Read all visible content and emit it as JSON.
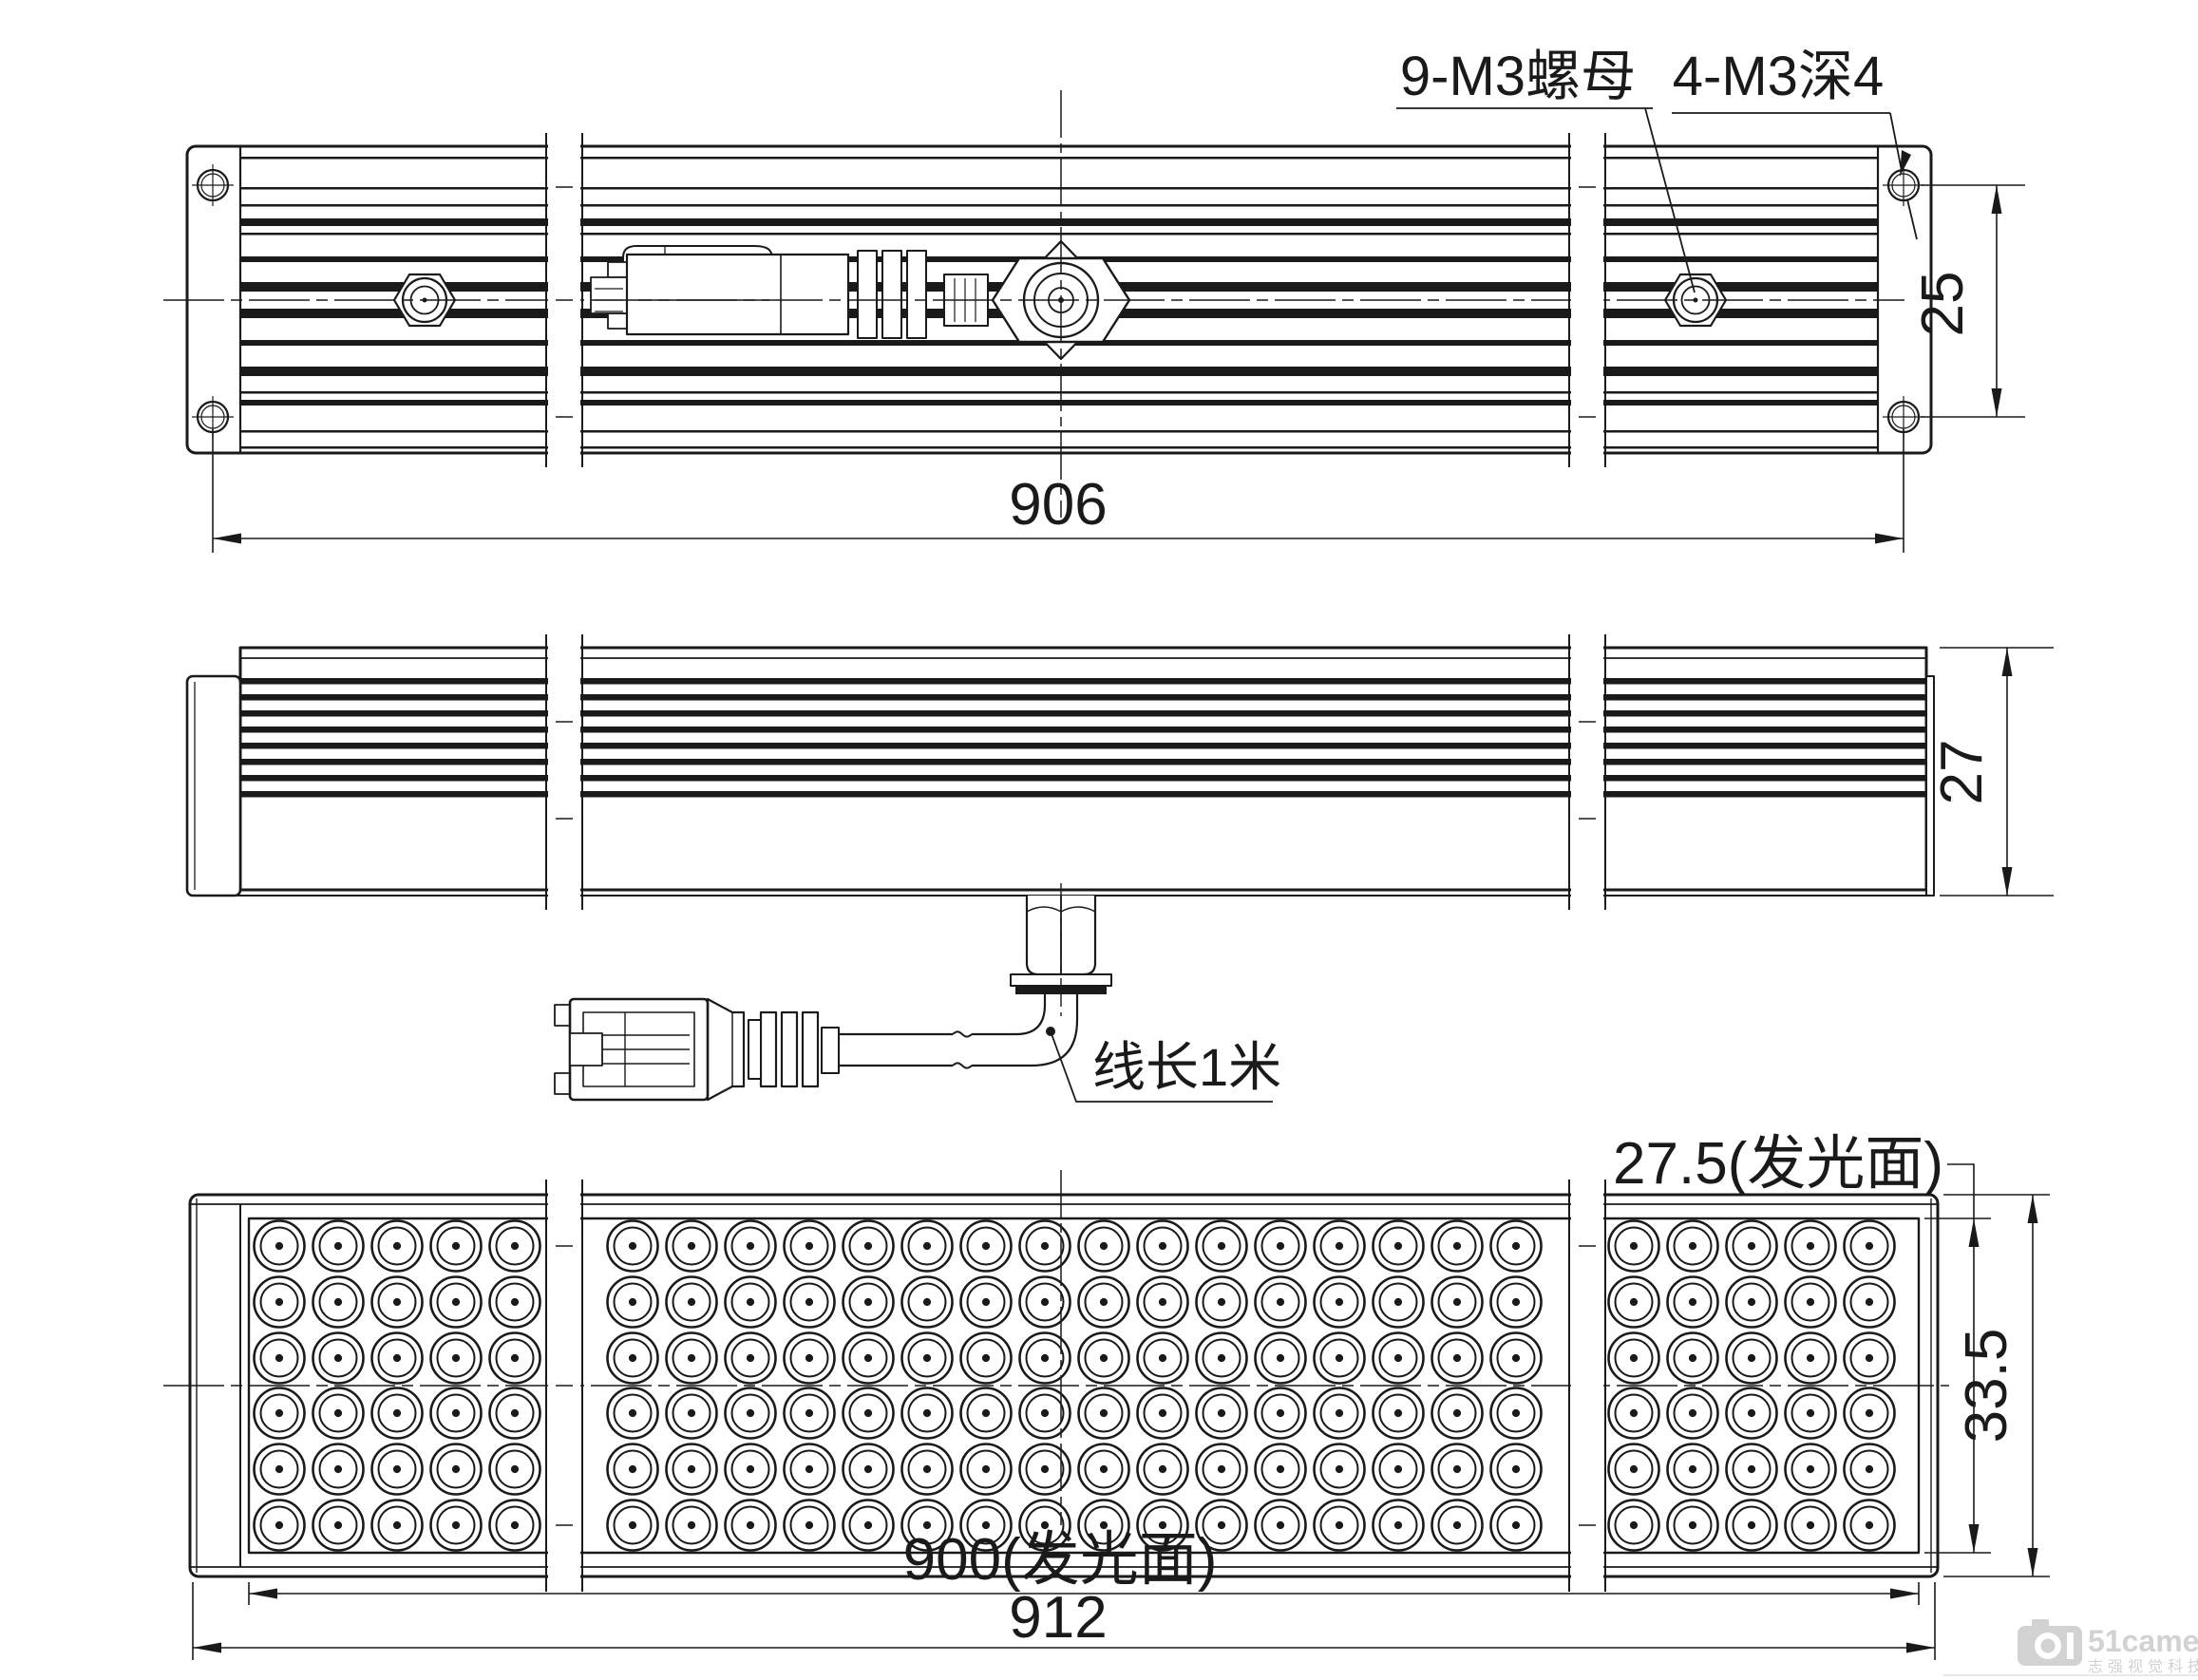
{
  "drawing": {
    "notes": {
      "nut": "9-M3螺母",
      "tap": "4-M3深4",
      "cable": "线长1米"
    },
    "dimensions": {
      "hole_span": "906",
      "hole_offset": "25",
      "side_height": "27",
      "lum_width": "27.5(发光面)",
      "front_height": "33.5",
      "lum_length": "900(发光面)",
      "overall_length": "912"
    },
    "watermark": {
      "logo": "51",
      "brand": "51camera",
      "subtitle": "志强视觉科技"
    },
    "colors": {
      "line": "#1a1a1a",
      "watermark": "#d2d2d2"
    }
  }
}
